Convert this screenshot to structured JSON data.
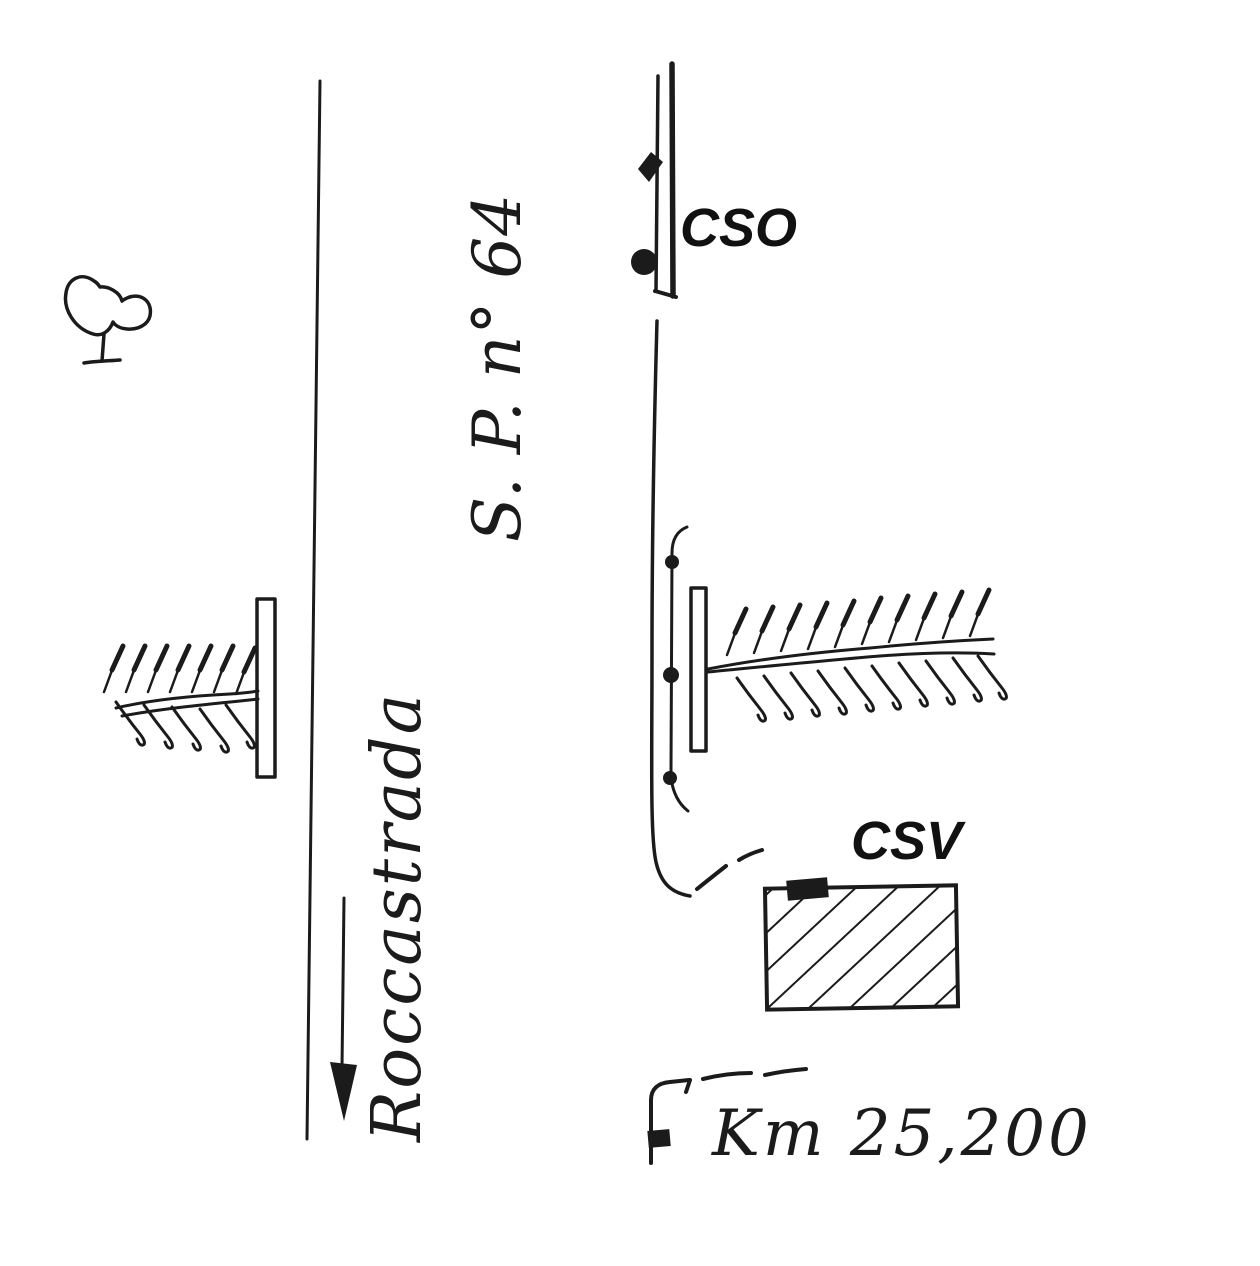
{
  "page": {
    "description": "Hand-drawn road location sketch",
    "paper_color": "#ffffff",
    "ink_color": "#1b1b1b"
  },
  "labels": {
    "road_name": "S. P. n° 64",
    "direction": "Roccastrada",
    "cso": "CSO",
    "csv": "CSV",
    "km": "Km 25,200"
  },
  "symbols": {
    "tree": "tree-icon",
    "direction_arrow": "down-arrow-icon",
    "guardrail": "narrow-rectangle-barrier",
    "stream_culvert": "double-wavy-line-with-hatched-banks",
    "fence_posts": "line-with-dot-markers",
    "building": "diagonal-hatched-rectangle-with-black-door",
    "km_stone": "small-black-square-marker"
  }
}
